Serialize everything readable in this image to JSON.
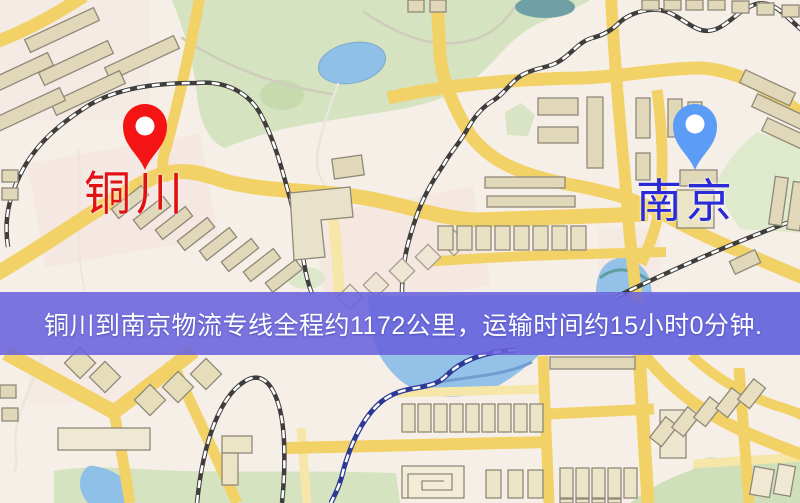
{
  "window": {
    "width": "800",
    "height": "503"
  },
  "banner": {
    "text": "铜川到南京物流专线全程约1172公里，运输时间约15小时0分钟.",
    "bg_color": "rgba(104,98,222,0.87)",
    "text_color": "#ffffff"
  },
  "route": {
    "from": "铜川",
    "to": "南京",
    "distance_km": "1172",
    "duration_hours": "15",
    "duration_minutes": "0"
  },
  "markers": {
    "origin": {
      "label": "铜川",
      "pin_color": "#f41414",
      "label_color": "#e01212"
    },
    "destination": {
      "label": "南京",
      "pin_color": "#5b9cf6",
      "label_color": "#2a2ad6"
    }
  },
  "map_theme": {
    "base": "#f6efe8",
    "road_yellow": "#f2d266",
    "road_pale": "#f6e6a8",
    "park_green": "#d5e3c0",
    "water_blue": "#94c1e7",
    "rail_dark": "#3f3e3c",
    "rail_water": "#2d3a95",
    "building_fill": "#e0d8b8"
  }
}
